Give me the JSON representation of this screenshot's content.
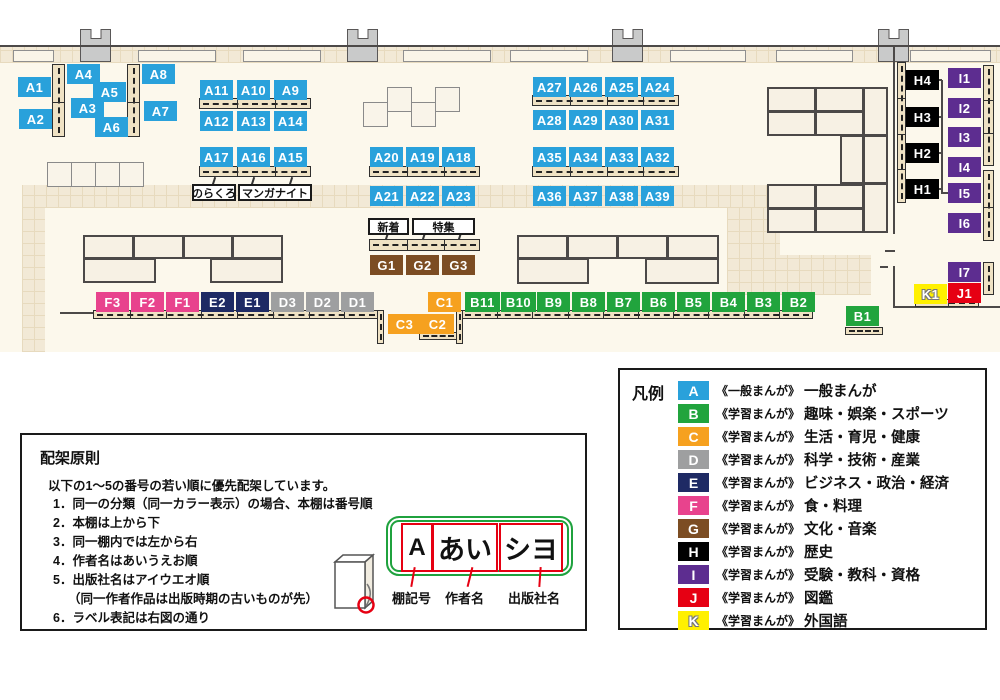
{
  "map": {
    "category_colors": {
      "A": "#29a1db",
      "B": "#21a43d",
      "C": "#f6a11f",
      "D": "#9e9fa0",
      "E": "#1e2a64",
      "F": "#e8438d",
      "G": "#7c4d23",
      "H": "#000000",
      "I": "#5d2d90",
      "J": "#e60013",
      "K": "#fff000"
    },
    "labels": [
      [
        "A1",
        "A",
        18,
        77
      ],
      [
        "A2",
        "A",
        19,
        109
      ],
      [
        "A4",
        "A",
        67,
        64
      ],
      [
        "A3",
        "A",
        71,
        98
      ],
      [
        "A5",
        "A",
        93,
        82
      ],
      [
        "A6",
        "A",
        95,
        117
      ],
      [
        "A8",
        "A",
        142,
        64
      ],
      [
        "A7",
        "A",
        144,
        101
      ],
      [
        "A11",
        "A",
        200,
        80
      ],
      [
        "A10",
        "A",
        237,
        80
      ],
      [
        "A9",
        "A",
        274,
        80
      ],
      [
        "A12",
        "A",
        200,
        111
      ],
      [
        "A13",
        "A",
        237,
        111
      ],
      [
        "A14",
        "A",
        274,
        111
      ],
      [
        "A17",
        "A",
        200,
        147
      ],
      [
        "A16",
        "A",
        237,
        147
      ],
      [
        "A15",
        "A",
        274,
        147
      ],
      [
        "A20",
        "A",
        370,
        147
      ],
      [
        "A19",
        "A",
        406,
        147
      ],
      [
        "A18",
        "A",
        442,
        147
      ],
      [
        "A21",
        "A",
        370,
        186
      ],
      [
        "A22",
        "A",
        406,
        186
      ],
      [
        "A23",
        "A",
        442,
        186
      ],
      [
        "A27",
        "A",
        533,
        77
      ],
      [
        "A26",
        "A",
        569,
        77
      ],
      [
        "A25",
        "A",
        605,
        77
      ],
      [
        "A24",
        "A",
        641,
        77
      ],
      [
        "A28",
        "A",
        533,
        110
      ],
      [
        "A29",
        "A",
        569,
        110
      ],
      [
        "A30",
        "A",
        605,
        110
      ],
      [
        "A31",
        "A",
        641,
        110
      ],
      [
        "A35",
        "A",
        533,
        147
      ],
      [
        "A34",
        "A",
        569,
        147
      ],
      [
        "A33",
        "A",
        605,
        147
      ],
      [
        "A32",
        "A",
        641,
        147
      ],
      [
        "A36",
        "A",
        533,
        186
      ],
      [
        "A37",
        "A",
        569,
        186
      ],
      [
        "A38",
        "A",
        605,
        186
      ],
      [
        "A39",
        "A",
        641,
        186
      ],
      [
        "G1",
        "G",
        370,
        255
      ],
      [
        "G2",
        "G",
        406,
        255
      ],
      [
        "G3",
        "G",
        442,
        255
      ],
      [
        "F3",
        "F",
        96,
        292
      ],
      [
        "F2",
        "F",
        131,
        292
      ],
      [
        "F1",
        "F",
        166,
        292
      ],
      [
        "E2",
        "E",
        201,
        292
      ],
      [
        "E1",
        "E",
        236,
        292
      ],
      [
        "D3",
        "D",
        271,
        292
      ],
      [
        "D2",
        "D",
        306,
        292
      ],
      [
        "D1",
        "D",
        341,
        292
      ],
      [
        "C1",
        "C",
        428,
        292
      ],
      [
        "C3",
        "C",
        388,
        314
      ],
      [
        "C2",
        "C",
        421,
        314
      ],
      [
        "B11",
        "B",
        465,
        292,
        35
      ],
      [
        "B10",
        "B",
        501,
        292,
        35
      ],
      [
        "B9",
        "B",
        537,
        292
      ],
      [
        "B8",
        "B",
        572,
        292
      ],
      [
        "B7",
        "B",
        607,
        292
      ],
      [
        "B6",
        "B",
        642,
        292
      ],
      [
        "B5",
        "B",
        677,
        292
      ],
      [
        "B4",
        "B",
        712,
        292
      ],
      [
        "B3",
        "B",
        747,
        292
      ],
      [
        "B2",
        "B",
        782,
        292
      ],
      [
        "B1",
        "B",
        846,
        306
      ],
      [
        "H4",
        "H",
        906,
        70
      ],
      [
        "H3",
        "H",
        906,
        107
      ],
      [
        "H2",
        "H",
        906,
        143
      ],
      [
        "H1",
        "H",
        906,
        179
      ],
      [
        "I1",
        "I",
        948,
        68
      ],
      [
        "I2",
        "I",
        948,
        98
      ],
      [
        "I3",
        "I",
        948,
        127
      ],
      [
        "I4",
        "I",
        948,
        157
      ],
      [
        "I5",
        "I",
        948,
        183
      ],
      [
        "I6",
        "I",
        948,
        213
      ],
      [
        "I7",
        "I",
        948,
        262
      ],
      [
        "K1",
        "K",
        914,
        284
      ],
      [
        "J1",
        "J",
        948,
        283
      ]
    ],
    "tags": [
      [
        "のらくろ",
        192,
        184,
        44
      ],
      [
        "マンガナイト",
        238,
        184,
        74
      ],
      [
        "新着",
        368,
        218,
        41
      ],
      [
        "特集",
        412,
        218,
        63
      ]
    ],
    "shelves_h": [
      [
        199,
        98,
        112,
        11,
        3
      ],
      [
        199,
        166,
        112,
        11,
        3
      ],
      [
        369,
        166,
        111,
        11,
        3
      ],
      [
        532,
        95,
        147,
        11,
        4
      ],
      [
        532,
        166,
        147,
        11,
        4
      ],
      [
        369,
        239,
        111,
        12,
        3
      ],
      [
        93,
        310,
        286,
        9,
        8
      ],
      [
        461,
        310,
        352,
        9,
        10
      ],
      [
        419,
        332,
        39,
        8,
        1
      ],
      [
        845,
        327,
        38,
        8,
        1
      ],
      [
        915,
        299,
        64,
        8,
        2
      ]
    ],
    "shelves_v": [
      [
        52,
        64,
        13,
        73,
        2
      ],
      [
        127,
        64,
        13,
        73,
        2
      ],
      [
        377,
        310,
        7,
        34,
        1
      ],
      [
        456,
        310,
        7,
        34,
        1
      ],
      [
        897,
        62,
        9,
        141,
        4
      ],
      [
        983,
        65,
        11,
        101,
        3
      ],
      [
        983,
        170,
        11,
        71,
        2
      ],
      [
        983,
        262,
        11,
        33,
        1
      ]
    ],
    "blocks": [
      [
        83,
        235,
        51,
        24
      ],
      [
        133,
        235,
        51,
        24
      ],
      [
        183,
        235,
        50,
        24
      ],
      [
        232,
        235,
        51,
        24
      ],
      [
        83,
        258,
        73,
        25
      ],
      [
        210,
        258,
        73,
        25
      ],
      [
        517,
        235,
        51,
        24
      ],
      [
        567,
        235,
        51,
        24
      ],
      [
        617,
        235,
        51,
        24
      ],
      [
        667,
        235,
        52,
        24
      ],
      [
        517,
        258,
        72,
        26
      ],
      [
        645,
        258,
        74,
        26
      ],
      [
        767,
        87,
        49,
        25
      ],
      [
        815,
        87,
        49,
        25
      ],
      [
        767,
        111,
        49,
        25
      ],
      [
        815,
        111,
        49,
        25
      ],
      [
        863,
        87,
        25,
        49
      ],
      [
        863,
        135,
        25,
        49
      ],
      [
        863,
        183,
        25,
        50
      ],
      [
        840,
        135,
        24,
        49
      ],
      [
        767,
        184,
        49,
        25
      ],
      [
        815,
        184,
        49,
        25
      ],
      [
        767,
        208,
        49,
        25
      ],
      [
        815,
        208,
        49,
        25
      ]
    ],
    "squares": [
      [
        47,
        162,
        25,
        25
      ],
      [
        71,
        162,
        25,
        25
      ],
      [
        95,
        162,
        25,
        25
      ],
      [
        119,
        162,
        25,
        25
      ],
      [
        363,
        102,
        25,
        25
      ],
      [
        387,
        87,
        25,
        25
      ],
      [
        411,
        102,
        25,
        25
      ],
      [
        435,
        87,
        25,
        25
      ]
    ],
    "pillars": [
      [
        80,
        29,
        31,
        33
      ],
      [
        347,
        29,
        31,
        33
      ],
      [
        612,
        29,
        31,
        33
      ],
      [
        878,
        29,
        31,
        33
      ]
    ],
    "windows": [
      [
        13,
        50,
        41,
        12
      ],
      [
        138,
        50,
        78,
        12
      ],
      [
        243,
        50,
        78,
        12
      ],
      [
        403,
        50,
        88,
        12
      ],
      [
        510,
        50,
        78,
        12
      ],
      [
        670,
        50,
        76,
        12
      ],
      [
        776,
        50,
        77,
        12
      ],
      [
        910,
        50,
        81,
        12
      ]
    ],
    "hatch": [
      [
        0,
        47,
        1000,
        16
      ],
      [
        22,
        185,
        758,
        23
      ],
      [
        22,
        208,
        23,
        144
      ],
      [
        727,
        208,
        53,
        48
      ],
      [
        727,
        255,
        144,
        40
      ]
    ],
    "walls": [
      [
        0,
        45,
        1000,
        2
      ],
      [
        893,
        47,
        2,
        187
      ],
      [
        885,
        250,
        10,
        2
      ],
      [
        893,
        266,
        2,
        41
      ],
      [
        880,
        266,
        8,
        2
      ],
      [
        893,
        306,
        107,
        2
      ],
      [
        60,
        312,
        34,
        2
      ]
    ],
    "wlines": [
      [
        941,
        80,
        2,
        114
      ],
      [
        938,
        79,
        4,
        2
      ],
      [
        938,
        116,
        4,
        2
      ],
      [
        938,
        152,
        4,
        2
      ],
      [
        938,
        188,
        4,
        2
      ],
      [
        941,
        192,
        8,
        2
      ]
    ],
    "pointers": [
      [
        213,
        177
      ],
      [
        252,
        177
      ],
      [
        290,
        177
      ],
      [
        386,
        232
      ],
      [
        423,
        232
      ],
      [
        459,
        232
      ]
    ]
  },
  "legend": {
    "title": "凡例",
    "rows": [
      {
        "letter": "A",
        "color": "#29a1db",
        "type": "《一般まんが》",
        "category": "一般まんが"
      },
      {
        "letter": "B",
        "color": "#21a43d",
        "type": "《学習まんが》",
        "category": "趣味・娯楽・スポーツ"
      },
      {
        "letter": "C",
        "color": "#f6a11f",
        "type": "《学習まんが》",
        "category": "生活・育児・健康"
      },
      {
        "letter": "D",
        "color": "#9e9fa0",
        "type": "《学習まんが》",
        "category": "科学・技術・産業"
      },
      {
        "letter": "E",
        "color": "#1e2a64",
        "type": "《学習まんが》",
        "category": "ビジネス・政治・経済"
      },
      {
        "letter": "F",
        "color": "#e8438d",
        "type": "《学習まんが》",
        "category": "食・料理"
      },
      {
        "letter": "G",
        "color": "#7c4d23",
        "type": "《学習まんが》",
        "category": "文化・音楽"
      },
      {
        "letter": "H",
        "color": "#000000",
        "type": "《学習まんが》",
        "category": "歴史"
      },
      {
        "letter": "I",
        "color": "#5d2d90",
        "type": "《学習まんが》",
        "category": "受験・教科・資格"
      },
      {
        "letter": "J",
        "color": "#e60013",
        "type": "《学習まんが》",
        "category": "図鑑"
      },
      {
        "letter": "K",
        "color": "#fff000",
        "type": "《学習まんが》",
        "category": "外国語",
        "outline": true
      }
    ]
  },
  "principles": {
    "title": "配架原則",
    "intro": "以下の1～5の番号の若い順に優先配架しています。",
    "items": [
      "1．同一の分類（同一カラー表示）の場合、本棚は番号順",
      "2．本棚は上から下",
      "3．同一棚内では左から右",
      "4．作者名はあいうえお順",
      "5．出版社名はアイウエオ順",
      "（同一作者作品は出版時期の古いものが先）",
      "6．ラベル表記は右図の通り"
    ],
    "diagram": {
      "boxes": [
        "A",
        "あい",
        "シヨ"
      ],
      "captions": [
        "棚記号",
        "作者名",
        "出版社名"
      ]
    }
  }
}
